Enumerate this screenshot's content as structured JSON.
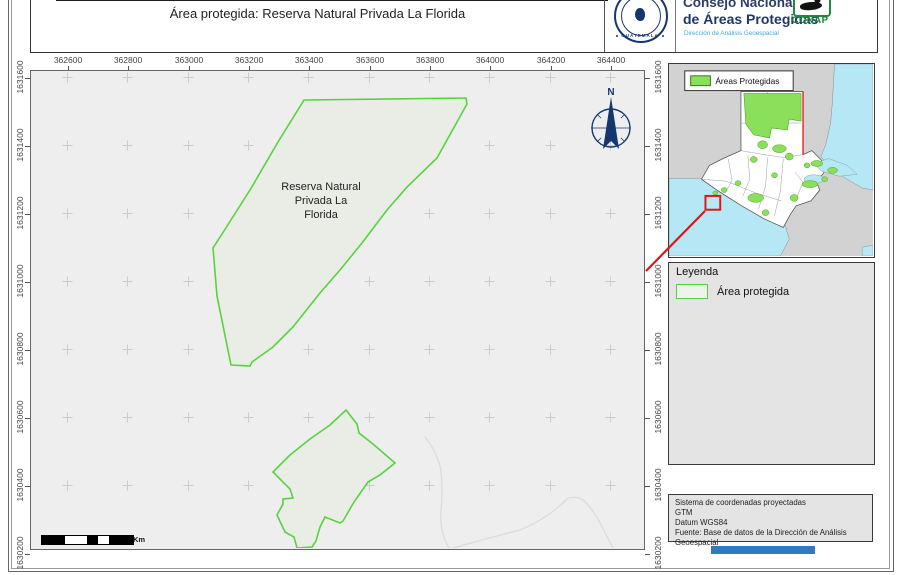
{
  "header": {
    "title": "Área protegida: Reserva Natural Privada La Florida",
    "org_line1": "Consejo Nacional",
    "org_line2": "de Áreas Protegidas",
    "org_line3": "Dirección de Análisis Geoespacial",
    "seal_caption": "GUATEMALA",
    "conap_caption": "CONAP"
  },
  "axes": {
    "x_labels": [
      "362600",
      "362800",
      "363000",
      "363200",
      "363400",
      "363600",
      "363800",
      "364000",
      "364200",
      "364400"
    ],
    "y_labels": [
      "1631600",
      "1631400",
      "1631200",
      "1631000",
      "1630800",
      "1630600",
      "1630400",
      "1630200"
    ]
  },
  "map": {
    "reserve_label_lines": [
      "Reserva Natural",
      "Privada La",
      "Florida"
    ],
    "north_label": "N",
    "scale_unit": "Km"
  },
  "overview": {
    "legend_label": "Áreas Protegidas"
  },
  "legend": {
    "title": "Leyenda",
    "item_label": "Área protegida"
  },
  "info_box": {
    "l1": "Sistema de coordenadas proyectadas",
    "l2": "GTM",
    "l3": "Datum WGS84",
    "l4": "Fuente: Base de datos de la Dirección de Análisis Geoespacial"
  },
  "colors": {
    "map_bg": "#eeeeee",
    "grid_cross": "#cbcbcb",
    "river": "#dcdcdc",
    "reserve_fill": "#e9ede6",
    "reserve_stroke": "#57d33f",
    "navy": "#15376e",
    "red": "#e51414",
    "ocean": "#b5e8f4",
    "land_gray": "#d2d2d2",
    "protected_green": "#8ae05a",
    "green_dark": "#49a129",
    "conap_green": "#17803a",
    "info_blue": "#3da9dc",
    "panel_bg": "#e4e4e4",
    "bar_blue": "#2e7bbf"
  },
  "geometry": {
    "grid": {
      "x_px": [
        68,
        128,
        189,
        249,
        309,
        370,
        430,
        490,
        551,
        611
      ],
      "y_px": [
        78,
        146,
        214,
        282,
        350,
        418,
        486,
        554
      ]
    },
    "reserve_polygons": [
      "273,29 435,27 436,33 406,87 376,116 356,139 331,172 309,199 289,222 262,256 242,276 221,291 219,295 200,294 186,225 182,177 191,163 219,119 247,71",
      "315,339 326,353 328,362 342,373 364,392 349,404 337,411 323,431 312,450 309,452 294,446 289,456 285,470 281,476 266,477 263,466 254,461 246,444 252,433 252,428 262,427 259,418 242,401 259,384 279,368 299,354"
    ],
    "river_paths": [
      "M394,366 Q406,381 410,399 Q412,420 410,439 Q408,460 419,479",
      "M416,479 Q449,469 489,459 Q516,448 536,428 Q544,424 552,429 Q564,440 571,456 Q577,467 582,477"
    ],
    "scalebar": {
      "segments": [
        {
          "w": 23,
          "c": "#000000"
        },
        {
          "w": 22,
          "c": "#ffffff"
        },
        {
          "w": 11,
          "c": "#000000"
        },
        {
          "w": 11,
          "c": "#ffffff"
        },
        {
          "w": 24,
          "c": "#000000"
        }
      ]
    },
    "red_line": {
      "x1": 646,
      "y1": 271,
      "x2": 705,
      "y2": 211
    },
    "overview": {
      "width": 207,
      "height": 195,
      "shapes": [
        {
          "type": "rect",
          "x": 0,
          "y": 0,
          "w": 207,
          "h": 195,
          "fill": "#d2d2d2",
          "stroke": "none",
          "sw": 0
        },
        {
          "type": "path",
          "d": "M168,0 L207,0 L207,128 L196,126 L184,119 L171,111 L162,103 L154,94 L159,82 L164,60 L166,36 L167,16 Z",
          "fill": "#b5e8f4",
          "stroke": "#8a8a8a",
          "sw": 0.5
        },
        {
          "type": "path",
          "d": "M0,116 L34,116 L118,164 L122,178 L113,195 L0,195 Z",
          "fill": "#b5e8f4",
          "stroke": "#8a8a8a",
          "sw": 0.5
        },
        {
          "type": "path",
          "d": "M196,186 L207,184 L207,195 L196,195 Z",
          "fill": "#b5e8f4",
          "stroke": "#8a8a8a",
          "sw": 0.4
        },
        {
          "type": "path",
          "d": "M73,28 L136,28 L136,92 L145,88 L153,96 L161,104 L156,112 L149,118 L153,128 L144,139 L129,144 L123,153 L116,166 L96,157 L72,143 L50,129 L33,117 L41,103 L55,96 L66,91 L73,88 Z",
          "fill": "#ffffff",
          "stroke": "#555555",
          "sw": 0.8
        },
        {
          "type": "path",
          "d": "M147,101 L162,96 L181,103 L191,112 L173,114 L155,109 Z",
          "fill": "#b5e8f4",
          "stroke": "#8a8a8a",
          "sw": 0.4
        },
        {
          "type": "ellipse",
          "cx": 147,
          "cy": 117,
          "rx": 10,
          "ry": 4.5,
          "fill": "#b5e8f4",
          "stroke": "#8a8a8a",
          "sw": 0.4
        },
        {
          "type": "path",
          "d": "M73,88 L96,92 L116,95 L136,92",
          "fill": "none",
          "stroke": "#999999",
          "sw": 0.5
        },
        {
          "type": "path",
          "d": "M60,96 L64,118 L57,131",
          "fill": "none",
          "stroke": "#999999",
          "sw": 0.5
        },
        {
          "type": "path",
          "d": "M80,93 L82,117 L75,134",
          "fill": "none",
          "stroke": "#999999",
          "sw": 0.5
        },
        {
          "type": "path",
          "d": "M100,95 L98,124 L91,147",
          "fill": "none",
          "stroke": "#999999",
          "sw": 0.5
        },
        {
          "type": "path",
          "d": "M116,96 L113,129 L107,154",
          "fill": "none",
          "stroke": "#999999",
          "sw": 0.5
        },
        {
          "type": "path",
          "d": "M33,117 L58,119 L88,131 L114,139",
          "fill": "none",
          "stroke": "#999999",
          "sw": 0.5
        },
        {
          "type": "path",
          "d": "M128,110 L136,120 L129,137",
          "fill": "none",
          "stroke": "#999999",
          "sw": 0.5
        },
        {
          "type": "path",
          "d": "M100,28 L100,56",
          "fill": "none",
          "stroke": "#999999",
          "sw": 0.5
        },
        {
          "type": "path",
          "d": "M118,30 L118,58",
          "fill": "none",
          "stroke": "#999999",
          "sw": 0.5
        },
        {
          "type": "path",
          "d": "M73,60 L134,60",
          "fill": "none",
          "stroke": "#999999",
          "sw": 0.5
        },
        {
          "type": "path",
          "d": "M76,30 L134,30 L134,58 L122,56 L120,67 L104,65 L102,75 L86,72 L78,61 Z",
          "fill": "#8ae05a",
          "stroke": "#49a129",
          "sw": 0.6
        },
        {
          "type": "ellipse",
          "cx": 95,
          "cy": 82,
          "rx": 5,
          "ry": 4,
          "fill": "#8ae05a",
          "stroke": "#49a129",
          "sw": 0.5
        },
        {
          "type": "ellipse",
          "cx": 112,
          "cy": 86,
          "rx": 7,
          "ry": 4,
          "fill": "#8ae05a",
          "stroke": "#49a129",
          "sw": 0.5
        },
        {
          "type": "ellipse",
          "cx": 86,
          "cy": 97,
          "rx": 3.5,
          "ry": 3,
          "fill": "#8ae05a",
          "stroke": "#49a129",
          "sw": 0.5
        },
        {
          "type": "ellipse",
          "cx": 122,
          "cy": 94,
          "rx": 4,
          "ry": 3.5,
          "fill": "#8ae05a",
          "stroke": "#49a129",
          "sw": 0.5
        },
        {
          "type": "ellipse",
          "cx": 140,
          "cy": 103,
          "rx": 3,
          "ry": 2.5,
          "fill": "#8ae05a",
          "stroke": "#49a129",
          "sw": 0.5
        },
        {
          "type": "ellipse",
          "cx": 150,
          "cy": 101,
          "rx": 6,
          "ry": 3,
          "fill": "#8ae05a",
          "stroke": "#49a129",
          "sw": 0.5
        },
        {
          "type": "ellipse",
          "cx": 166,
          "cy": 108,
          "rx": 5,
          "ry": 3,
          "fill": "#8ae05a",
          "stroke": "#49a129",
          "sw": 0.5
        },
        {
          "type": "ellipse",
          "cx": 70,
          "cy": 121,
          "rx": 3,
          "ry": 2.5,
          "fill": "#8ae05a",
          "stroke": "#49a129",
          "sw": 0.5
        },
        {
          "type": "ellipse",
          "cx": 56,
          "cy": 128,
          "rx": 3,
          "ry": 2.5,
          "fill": "#8ae05a",
          "stroke": "#49a129",
          "sw": 0.5
        },
        {
          "type": "ellipse",
          "cx": 88,
          "cy": 136,
          "rx": 8,
          "ry": 4.5,
          "fill": "#8ae05a",
          "stroke": "#49a129",
          "sw": 0.5
        },
        {
          "type": "ellipse",
          "cx": 98,
          "cy": 151,
          "rx": 3.5,
          "ry": 3,
          "fill": "#8ae05a",
          "stroke": "#49a129",
          "sw": 0.5
        },
        {
          "type": "ellipse",
          "cx": 127,
          "cy": 136,
          "rx": 4,
          "ry": 3.5,
          "fill": "#8ae05a",
          "stroke": "#49a129",
          "sw": 0.5
        },
        {
          "type": "ellipse",
          "cx": 143,
          "cy": 122,
          "rx": 8,
          "ry": 3.5,
          "fill": "#8ae05a",
          "stroke": "#49a129",
          "sw": 0.5
        },
        {
          "type": "ellipse",
          "cx": 107,
          "cy": 113,
          "rx": 3,
          "ry": 2.5,
          "fill": "#8ae05a",
          "stroke": "#49a129",
          "sw": 0.5
        },
        {
          "type": "ellipse",
          "cx": 47,
          "cy": 131,
          "rx": 2.5,
          "ry": 2,
          "fill": "#8ae05a",
          "stroke": "#49a129",
          "sw": 0.5
        },
        {
          "type": "ellipse",
          "cx": 158,
          "cy": 117,
          "rx": 3,
          "ry": 2.5,
          "fill": "#8ae05a",
          "stroke": "#49a129",
          "sw": 0.5
        },
        {
          "type": "path",
          "d": "M136,28 L136,92",
          "fill": "none",
          "stroke": "#ee1111",
          "sw": 1.3
        },
        {
          "type": "rect",
          "x": 16,
          "y": 7,
          "w": 110,
          "h": 20,
          "fill": "#ffffff",
          "stroke": "#333333",
          "sw": 1
        },
        {
          "type": "rect",
          "x": 22,
          "y": 12,
          "w": 20,
          "h": 10,
          "fill": "#8ae05a",
          "stroke": "#2f7d1e",
          "sw": 1
        },
        {
          "type": "text",
          "x": 47,
          "y": 20.5,
          "size": 8.5,
          "fill": "#111111",
          "bind": "overview.legend_label"
        },
        {
          "type": "rect",
          "x": 37,
          "y": 134,
          "w": 15,
          "h": 14,
          "fill": "none",
          "stroke": "#e51414",
          "sw": 2
        }
      ]
    }
  }
}
